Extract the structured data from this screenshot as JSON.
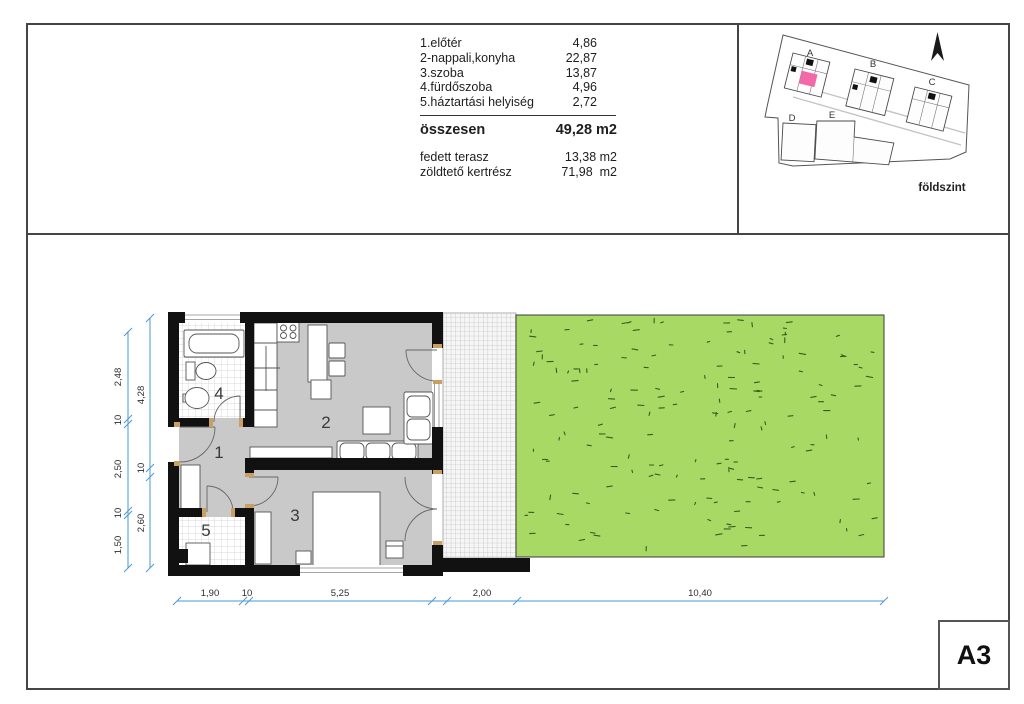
{
  "summary_table": {
    "rows": [
      {
        "label": "1.előtér",
        "value": "4,86"
      },
      {
        "label": "2-nappali,konyha",
        "value": "22,87"
      },
      {
        "label": "3.szoba",
        "value": "13,87"
      },
      {
        "label": "4.fürdőszoba",
        "value": "4,96"
      },
      {
        "label": "5.háztartási helyiség",
        "value": "2,72"
      }
    ],
    "total": {
      "label": "összesen",
      "value": "49,28 m2"
    },
    "extras": [
      {
        "label": "fedett terasz",
        "value": "13,38 m2"
      },
      {
        "label": "zöldtető kertrész",
        "value": "71,98  m2"
      }
    ]
  },
  "site_plan": {
    "buildings": [
      "A",
      "B",
      "C",
      "D",
      "E"
    ],
    "level_label": "földszint",
    "highlight_color": "#f268a8"
  },
  "floor_plan": {
    "room_numbers": [
      "1",
      "2",
      "3",
      "4",
      "5"
    ],
    "dimensions": {
      "bottom": [
        "1,90",
        "10",
        "5,25",
        "2,00",
        "10,40"
      ],
      "left_outer": [
        "2,48",
        "10",
        "2,50",
        "10",
        "1,50"
      ],
      "left_inner": [
        "4,28",
        "10",
        "2,60"
      ]
    }
  },
  "sheet_label": "A3",
  "colors": {
    "garden_green": "#a7d964",
    "dimension_blue": "#4a9ad2",
    "floor_gray": "#c9c9c9",
    "wall_black": "#111111"
  }
}
